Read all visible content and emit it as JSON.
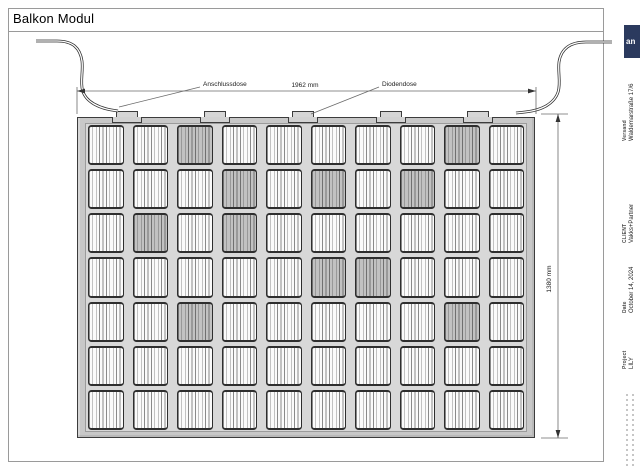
{
  "title": "Balkon Modul",
  "drawing": {
    "labels": {
      "junction_box": "Anschlussdose",
      "diode_box": "Diodendose"
    },
    "dimensions": {
      "width": "1962 mm",
      "height": "1380 mm"
    }
  },
  "panel": {
    "grid": {
      "rows": 7,
      "cols": 10,
      "shaded": [
        [
          1,
          3
        ],
        [
          2,
          4
        ],
        [
          3,
          2
        ],
        [
          3,
          4
        ],
        [
          2,
          6
        ],
        [
          4,
          6
        ],
        [
          2,
          8
        ],
        [
          1,
          9
        ],
        [
          5,
          3
        ],
        [
          5,
          9
        ],
        [
          4,
          7
        ]
      ]
    },
    "junction_tab_centers": [
      127,
      215,
      303,
      391,
      478
    ]
  },
  "titleblock": {
    "logo_text": "an",
    "logo_color": "#2b3a5e",
    "entries": [
      {
        "label": "Versand",
        "value": "Waldemarstraße 17/6"
      },
      {
        "label": "CLIENT",
        "value": "Vakks+Partner"
      },
      {
        "label": "Date",
        "value": "October 14, 2024"
      },
      {
        "label": "Project",
        "value": "LILY"
      }
    ]
  }
}
